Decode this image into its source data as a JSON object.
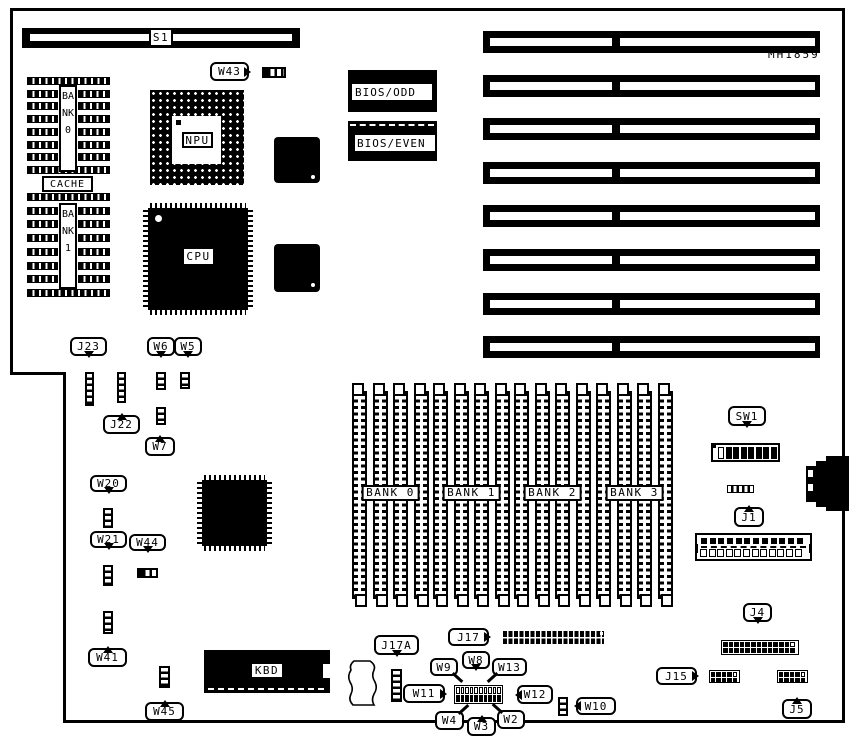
{
  "part_number": "MH1859",
  "chips": {
    "npu": "NPU",
    "cpu": "CPU",
    "kbd": "KBD",
    "cache": "CACHE",
    "bank0_vertical": "BANK0",
    "bank1_vertical": "BANK1",
    "bios_odd": "BIOS/ODD",
    "bios_even": "BIOS/EVEN"
  },
  "memory_banks": [
    "BANK 0",
    "BANK 1",
    "BANK 2",
    "BANK 3"
  ],
  "expansion_slots": {
    "count": 8
  },
  "dip_switch": {
    "positions": 8,
    "off_positions": 1
  },
  "power_connector": {
    "pins": 12
  },
  "j4_header": {
    "cols": 13,
    "rows": 2
  },
  "j15_header": {
    "cols": 5,
    "rows": 2
  },
  "j5_header": {
    "cols": 5,
    "rows": 2
  },
  "w_block": {
    "cols": 10,
    "rows": 2
  },
  "refs": {
    "s1": "S1",
    "w43": "W43",
    "j23": "J23",
    "j22": "J22",
    "w6": "W6",
    "w5": "W5",
    "w7": "W7",
    "w20": "W20",
    "w21": "W21",
    "w44": "W44",
    "w41": "W41",
    "w45": "W45",
    "sw1": "SW1",
    "j1": "J1",
    "j4": "J4",
    "j15": "J15",
    "j5": "J5",
    "j17": "J17",
    "j17a": "J17A",
    "w8": "W8",
    "w9": "W9",
    "w13": "W13",
    "w11": "W11",
    "w12": "W12",
    "w10": "W10",
    "w4": "W4",
    "w3": "W3",
    "w2": "W2"
  },
  "colors": {
    "line": "#000000",
    "background": "#ffffff"
  }
}
